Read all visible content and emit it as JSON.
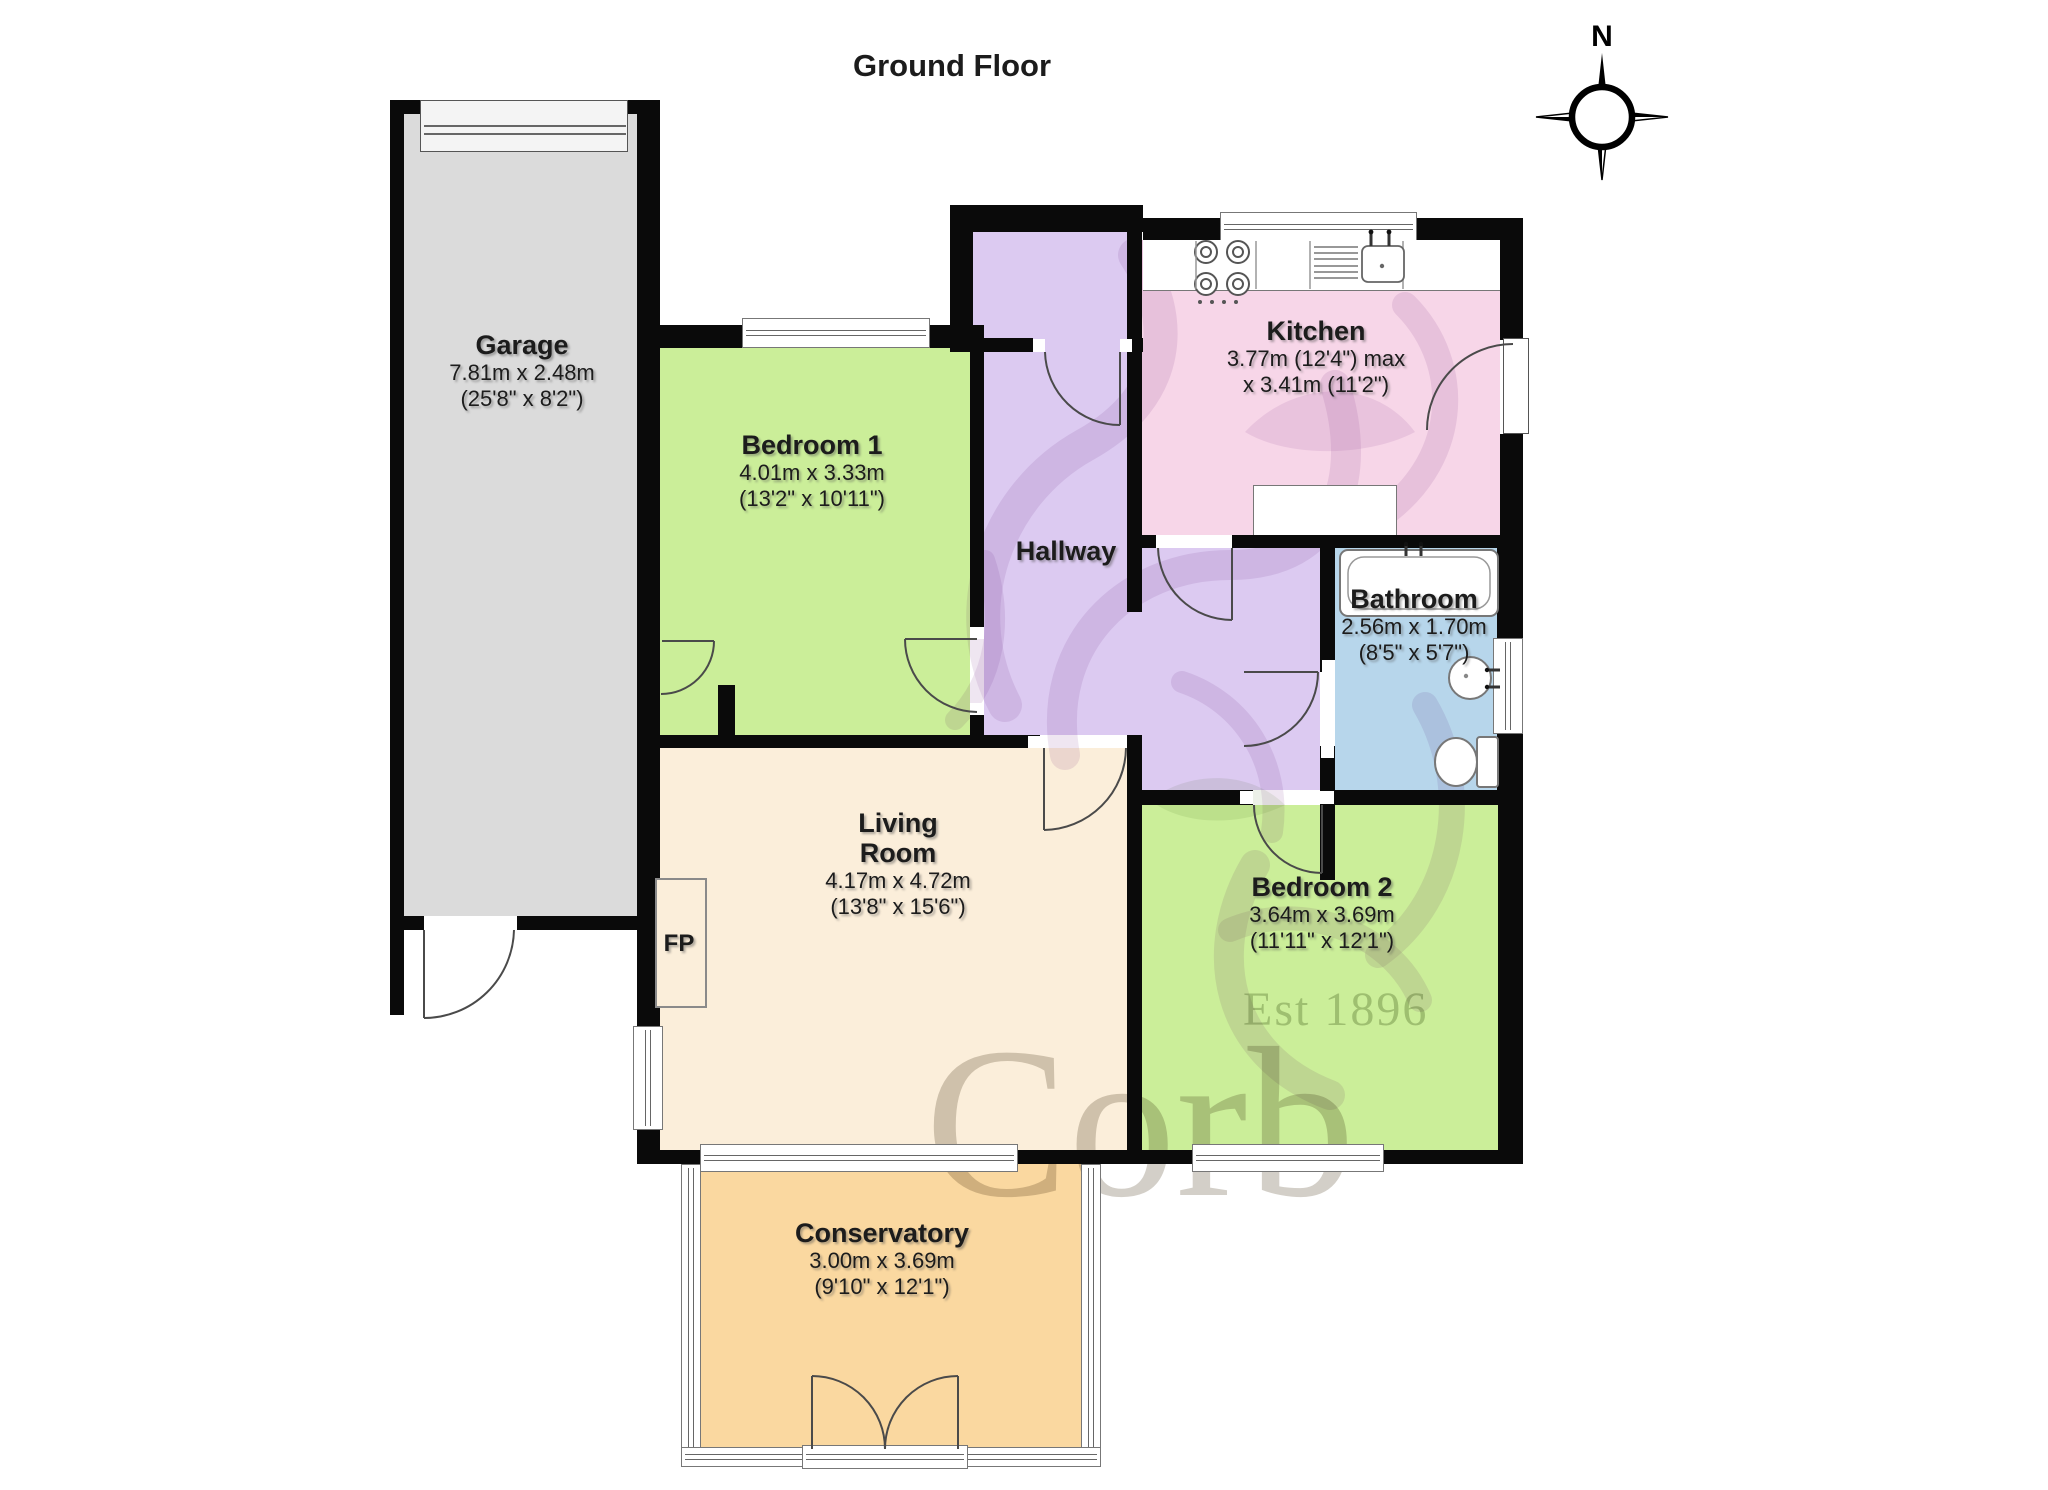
{
  "title": "Ground Floor",
  "compass": {
    "label": "N"
  },
  "rooms": [
    {
      "key": "garage",
      "name": "Garage",
      "dims": [
        "7.81m x 2.48m",
        "(25'8\" x 8'2\")"
      ]
    },
    {
      "key": "bedroom1",
      "name": "Bedroom 1",
      "dims": [
        "4.01m x 3.33m",
        "(13'2\" x 10'11\")"
      ]
    },
    {
      "key": "hallway",
      "name": "Hallway",
      "dims": []
    },
    {
      "key": "kitchen",
      "name": "Kitchen",
      "dims": [
        "3.77m (12'4\") max",
        "x 3.41m (11'2\")"
      ]
    },
    {
      "key": "bathroom",
      "name": "Bathroom",
      "dims": [
        "2.56m x 1.70m",
        "(8'5\" x 5'7\")"
      ]
    },
    {
      "key": "living",
      "name_line1": "Living",
      "name_line2": "Room",
      "dims": [
        "4.17m x 4.72m",
        "(13'8\" x 15'6\")"
      ]
    },
    {
      "key": "bedroom2",
      "name": "Bedroom 2",
      "dims": [
        "3.64m x 3.69m",
        "(11'11\" x 12'1\")"
      ]
    },
    {
      "key": "conservatory",
      "name": "Conservatory",
      "dims": [
        "3.00m x 3.69m",
        "(9'10\" x 12'1\")"
      ]
    }
  ],
  "fireplace_label": "FP",
  "watermark": {
    "line1": "Corb",
    "line2": "Est 1896"
  },
  "colors": {
    "wall": "#0a0a0a",
    "garage_floor": "#dbdbdb",
    "garage_door": "#f4f4f4",
    "bedroom": "#cbee99",
    "hallway": "#dccaf1",
    "kitchen": "#f7d6e8",
    "bathroom": "#b7d6eb",
    "living": "#fbeeda",
    "conservatory": "#fad8a0",
    "watermark_text": "#6d5f46",
    "watermark_griffin": "#9966aa"
  }
}
